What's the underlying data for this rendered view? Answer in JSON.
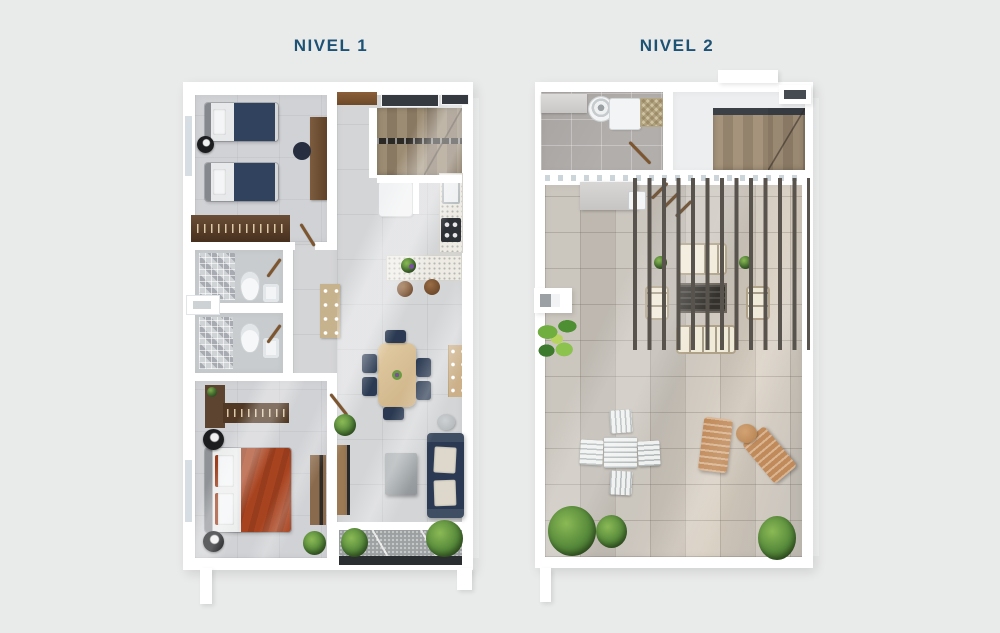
{
  "view": {
    "background": "#e9eaea",
    "description_units": "two-level residential floor plan rendering"
  },
  "plans": [
    {
      "label": "NIVEL 1"
    },
    {
      "label": "NIVEL 2"
    }
  ],
  "palette": {
    "bg": "#e9eaea",
    "title_text": "#1d5274",
    "wall": "#ffffff",
    "floor_interior": "#d4d5d7",
    "floor_terrace": "#c6c0b8",
    "bed_navy": "#31425f",
    "bed_rust": "#a8431f",
    "sofa_navy": "#2b3a52",
    "wood_light": "#d8bd94",
    "wood_closet": "#4e3826",
    "stair_wood": "#9c8c73",
    "pergola_slat": "#58534c",
    "outdoor_cream": "#f0ead9",
    "lounger_tan": "#c08a5a",
    "plant_green": "#55883a"
  }
}
